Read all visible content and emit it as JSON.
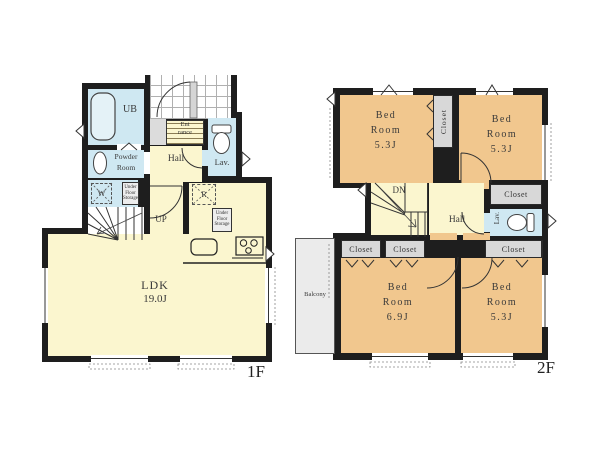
{
  "floor1": {
    "label": "1F",
    "ldk": {
      "name": "LDK",
      "size": "19.0J"
    },
    "rooms": {
      "ub": "UB",
      "entrance": {
        "line1": "Ent",
        "line2": "rance"
      },
      "hall": "Hall",
      "lav": "Lav.",
      "powder": {
        "line1": "Powder",
        "line2": "Room"
      },
      "washer": "W",
      "fridge": "R",
      "up": "UP",
      "under_floor_storage": {
        "line1": "Under",
        "line2": "Floor",
        "line3": "Storage"
      }
    }
  },
  "floor2": {
    "label": "2F",
    "stairs": "DN",
    "hall": "Hall",
    "lav": "Lav.",
    "closet_label": "Closet",
    "balcony": "Balcony",
    "bedrooms": [
      {
        "line1": "Bed",
        "line2": "Room",
        "size": "5.3J"
      },
      {
        "line1": "Bed",
        "line2": "Room",
        "size": "5.3J"
      },
      {
        "line1": "Bed",
        "line2": "Room",
        "size": "6.9J"
      },
      {
        "line1": "Bed",
        "line2": "Room",
        "size": "5.3J"
      }
    ]
  },
  "colors": {
    "wall": "#1e1e1e",
    "floor_yellow": "#fbf6cf",
    "bedroom_orange": "#f1c78e",
    "wet_blue": "#cfe8f2",
    "closet_gray": "#d8d8d8",
    "balcony_gray": "#ebebeb"
  }
}
